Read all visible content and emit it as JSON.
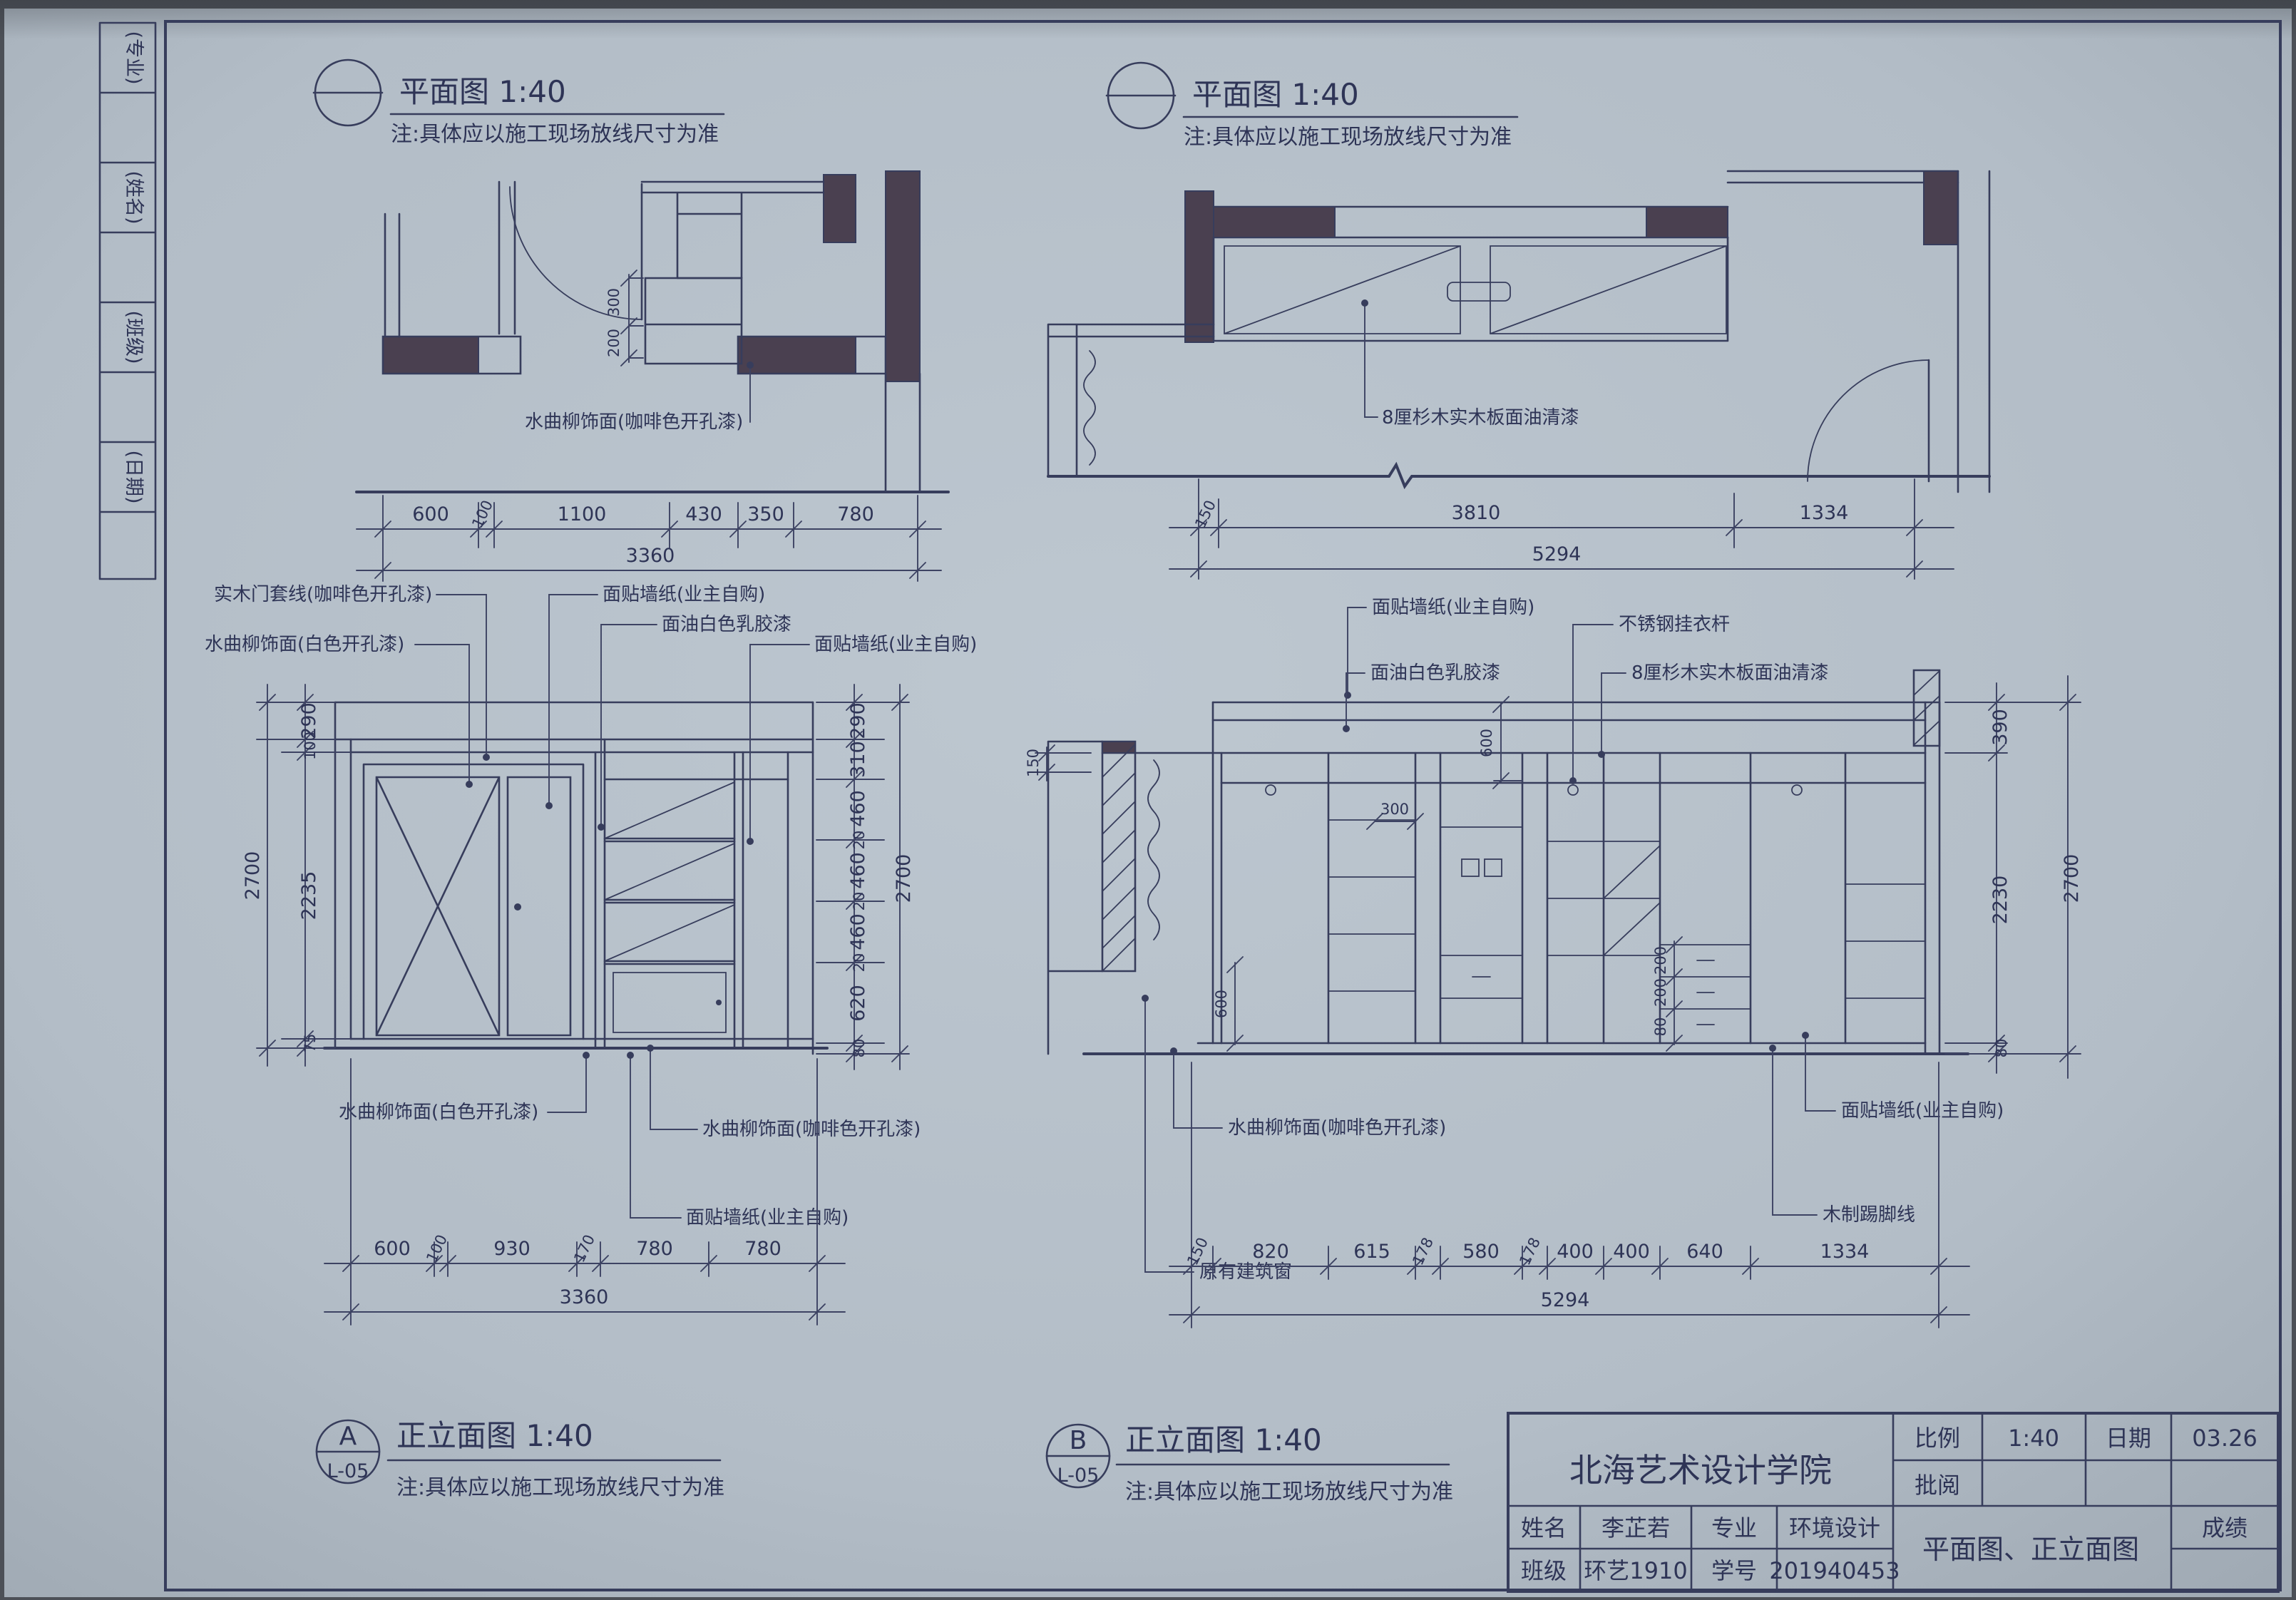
{
  "edge_strip": {
    "labels": [
      "(专业)",
      "(姓名)",
      "(班级)",
      "(日期)"
    ]
  },
  "plan_left": {
    "title": "平面图 1:40",
    "note": "注:具体应以施工现场放线尺寸为准",
    "callout": "水曲柳饰面(咖啡色开孔漆)",
    "dims": {
      "segments": [
        "600",
        "100",
        "1100",
        "430",
        "350",
        "780"
      ],
      "total": "3360",
      "inner": [
        "300",
        "200"
      ]
    }
  },
  "plan_right": {
    "title": "平面图 1:40",
    "note": "注:具体应以施工现场放线尺寸为准",
    "callout": "8厘杉木实木板面油清漆",
    "dims": {
      "segments": [
        "150",
        "3810",
        "1334"
      ],
      "total": "5294"
    }
  },
  "elev_a": {
    "symbol": {
      "letter": "A",
      "sheet": "L-05"
    },
    "title": "正立面图 1:40",
    "note": "注:具体应以施工现场放线尺寸为准",
    "callouts_top": [
      "实木门套线(咖啡色开孔漆)",
      "水曲柳饰面(白色开孔漆)",
      "面贴墙纸(业主自购)",
      "面油白色乳胶漆",
      "面贴墙纸(业主自购)"
    ],
    "callouts_bottom": [
      "水曲柳饰面(白色开孔漆)",
      "水曲柳饰面(咖啡色开孔漆)",
      "面贴墙纸(业主自购)"
    ],
    "dims": {
      "left": [
        "290",
        "100",
        "2235",
        "75"
      ],
      "left_total": "2700",
      "right": [
        "290",
        "310",
        "460",
        "20",
        "460",
        "20",
        "460",
        "20",
        "620",
        "80"
      ],
      "right_total": "2700",
      "bottom": [
        "600",
        "100",
        "930",
        "170",
        "780",
        "780"
      ],
      "bottom_total": "3360"
    }
  },
  "elev_b": {
    "symbol": {
      "letter": "B",
      "sheet": "L-05"
    },
    "title": "正立面图 1:40",
    "note": "注:具体应以施工现场放线尺寸为准",
    "callouts_top": [
      "面贴墙纸(业主自购)",
      "面油白色乳胶漆",
      "不锈钢挂衣杆",
      "8厘杉木实木板面油清漆"
    ],
    "callouts_bottom": [
      "水曲柳饰面(咖啡色开孔漆)",
      "原有建筑窗",
      "面贴墙纸(业主自购)",
      "木制踢脚线"
    ],
    "dims": {
      "left": [
        "150"
      ],
      "right": [
        "390",
        "2230",
        "80"
      ],
      "right_total": "2700",
      "inner": [
        "600",
        "300",
        "600",
        "200",
        "200",
        "80"
      ],
      "bottom": [
        "150",
        "820",
        "615",
        "178",
        "580",
        "178",
        "400",
        "400",
        "640",
        "1334"
      ],
      "bottom_total": "5294"
    }
  },
  "title_block": {
    "school": "北海艺术设计学院",
    "scale_label": "比例",
    "scale_value": "1:40",
    "date_label": "日期",
    "date_value": "03.26",
    "review_label": "批阅",
    "name_label": "姓名",
    "name_value": "李芷若",
    "major_label": "专业",
    "major_value": "环境设计",
    "class_label": "班级",
    "class_value": "环艺1910",
    "id_label": "学号",
    "id_value": "201940453",
    "sheet_title": "平面图、正立面图",
    "grade_label": "成绩"
  },
  "colors": {
    "paper": "#b6c0c9",
    "ink": "#373d5c",
    "wall_fill": "#4a4050"
  }
}
